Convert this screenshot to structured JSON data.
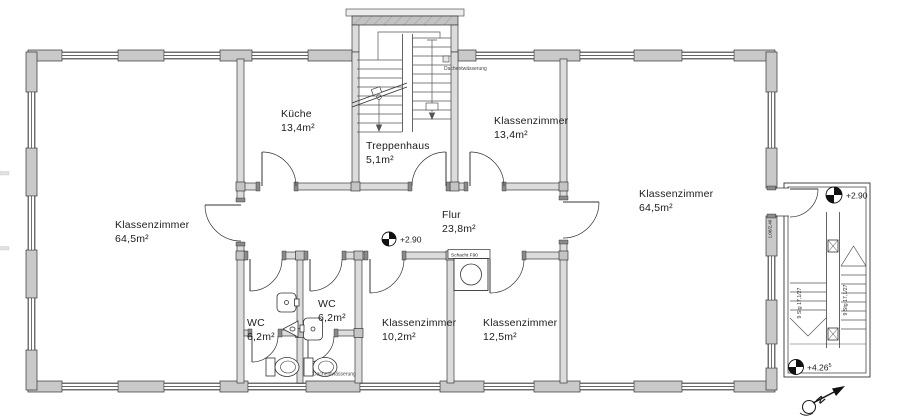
{
  "drawing": {
    "kind": "architectural floor plan",
    "rooms": [
      {
        "id": "klassenzimmer-left",
        "name": "Klassenzimmer",
        "area": "64,5m²"
      },
      {
        "id": "kueche",
        "name": "Küche",
        "area": "13,4m²"
      },
      {
        "id": "treppenhaus",
        "name": "Treppenhaus",
        "area": "5,1m²"
      },
      {
        "id": "klassenzimmer-top",
        "name": "Klassenzimmer",
        "area": "13,4m²"
      },
      {
        "id": "klassenzimmer-right",
        "name": "Klassenzimmer",
        "area": "64,5m²"
      },
      {
        "id": "flur",
        "name": "Flur",
        "area": "23,8m²"
      },
      {
        "id": "wc-left",
        "name": "WC",
        "area": "6,2m²"
      },
      {
        "id": "wc-right",
        "name": "WC",
        "area": "6,2m²"
      },
      {
        "id": "klassenzimmer-small-left",
        "name": "Klassenzimmer",
        "area": "10,2m²"
      },
      {
        "id": "klassenzimmer-small-right",
        "name": "Klassenzimmer",
        "area": "12,5m²"
      }
    ],
    "levels": {
      "corridor": "+2.90",
      "annex_top": "+2.90",
      "annex_bottom": "+4.26",
      "annex_bottom_sup": "5"
    },
    "stairs": {
      "flight_left": "9 Stg 17,1/27",
      "flight_right": "9 Stg 17,1/27"
    },
    "annotations": {
      "roof_drain_top": "Dachentwässerung",
      "roof_drain_bottom": "Dachentwässerung",
      "shaft": "Schacht F90",
      "door_dimension": "1,06/2,46",
      "north": "N"
    },
    "colors": {
      "wall_fill": "#dcdcdc",
      "pier_fill": "#c9c9c9",
      "line": "#3a3a3a",
      "paper": "#ffffff"
    }
  }
}
